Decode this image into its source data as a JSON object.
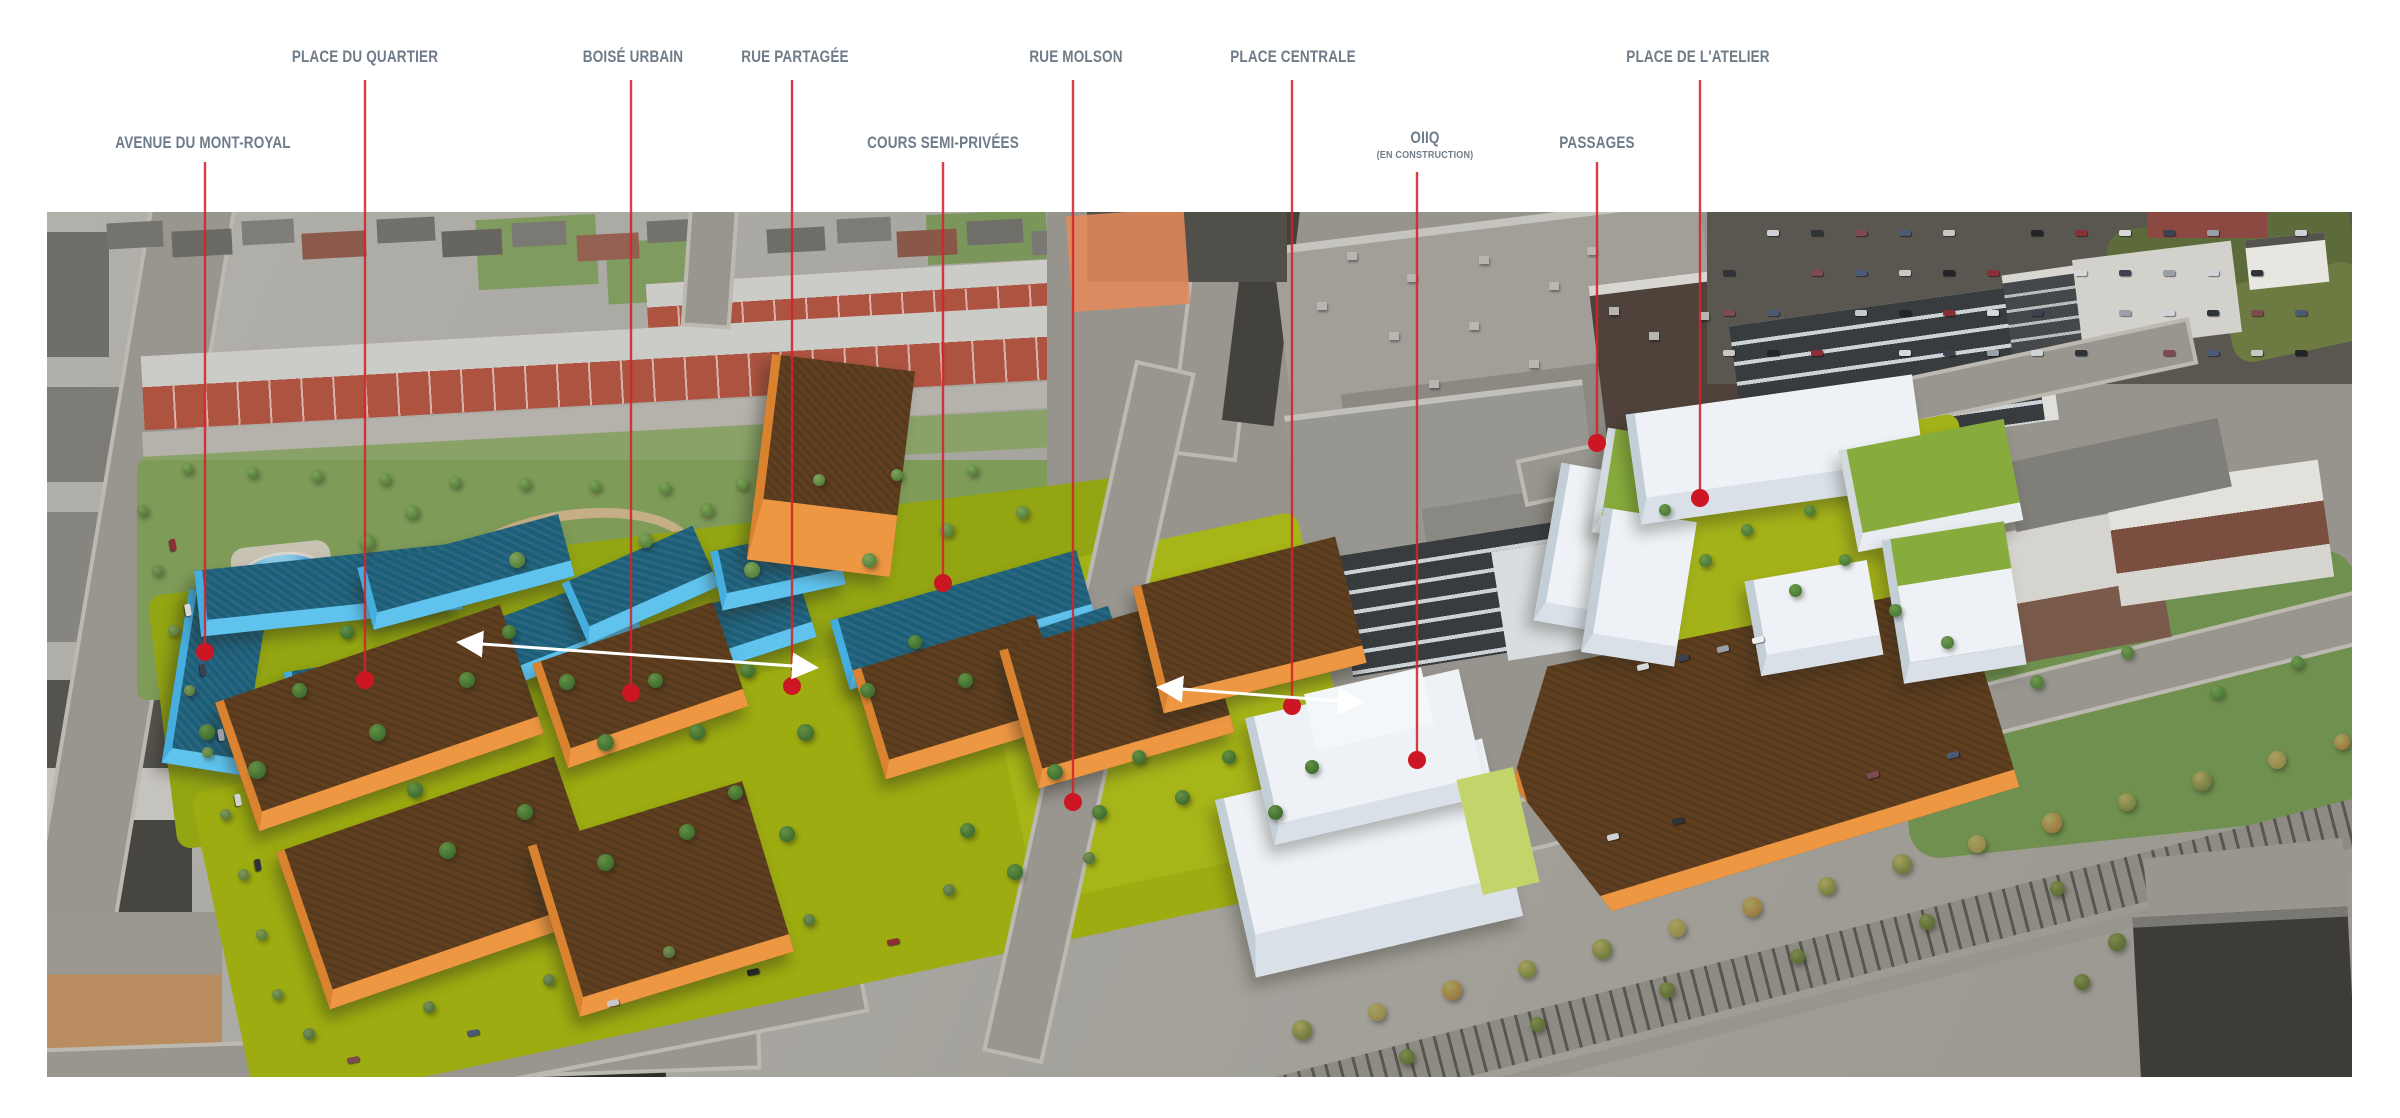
{
  "diagram": {
    "callouts": [
      {
        "id": "place-du-quartier",
        "label": "PLACE DU QUARTIER",
        "x": 365,
        "label_y": 58,
        "line_top": 80,
        "dot_x": 365,
        "dot_y": 680
      },
      {
        "id": "boise-urbain",
        "label": "BOISÉ URBAIN",
        "x": 633,
        "label_y": 58,
        "line_top": 80,
        "dot_x": 631,
        "dot_y": 693
      },
      {
        "id": "rue-partagee",
        "label": "RUE PARTAGÉE",
        "x": 795,
        "label_y": 58,
        "line_top": 80,
        "dot_x": 792,
        "dot_y": 686
      },
      {
        "id": "rue-molson",
        "label": "RUE MOLSON",
        "x": 1076,
        "label_y": 58,
        "line_top": 80,
        "dot_x": 1073,
        "dot_y": 802
      },
      {
        "id": "place-centrale",
        "label": "PLACE CENTRALE",
        "x": 1293,
        "label_y": 58,
        "line_top": 80,
        "dot_x": 1292,
        "dot_y": 706
      },
      {
        "id": "place-de-l-atelier",
        "label": "PLACE DE L'ATELIER",
        "x": 1698,
        "label_y": 58,
        "line_top": 80,
        "dot_x": 1700,
        "dot_y": 498
      },
      {
        "id": "avenue-du-mont-royal",
        "label": "AVENUE DU MONT-ROYAL",
        "x": 203,
        "label_y": 144,
        "line_top": 162,
        "dot_x": 205,
        "dot_y": 652
      },
      {
        "id": "cours-semi-privees",
        "label": "COURS SEMI-PRIVÉES",
        "x": 943,
        "label_y": 144,
        "line_top": 162,
        "dot_x": 943,
        "dot_y": 583
      },
      {
        "id": "oiiq",
        "label": "OIIQ",
        "sublabel": "(EN CONSTRUCTION)",
        "x": 1425,
        "label_y": 139,
        "sublabel_y": 156,
        "line_top": 172,
        "dot_x": 1417,
        "dot_y": 760
      },
      {
        "id": "passages",
        "label": "PASSAGES",
        "x": 1597,
        "label_y": 144,
        "line_top": 162,
        "dot_x": 1597,
        "dot_y": 443
      }
    ],
    "arrows": [
      {
        "id": "shared-street-axis",
        "x1": 468,
        "y1": 643,
        "x2": 807,
        "y2": 667
      },
      {
        "id": "central-place-axis",
        "x1": 1168,
        "y1": 688,
        "x2": 1353,
        "y2": 702
      }
    ],
    "colors": {
      "accent_red": "#d2242c",
      "dot_red": "#cd1623",
      "label_gray": "#6e7c89",
      "arrow_white": "#ffffff",
      "massing_blue_wall": "#5fc3ee",
      "massing_blue_roof": "#1d5e78",
      "massing_orange_wall": "#ee9742",
      "massing_orange_roof": "#5f3f20",
      "massing_white": "#eef2f6",
      "massing_green_roof": "#87ab3c",
      "site_lawn_green": "#9dac11"
    }
  }
}
